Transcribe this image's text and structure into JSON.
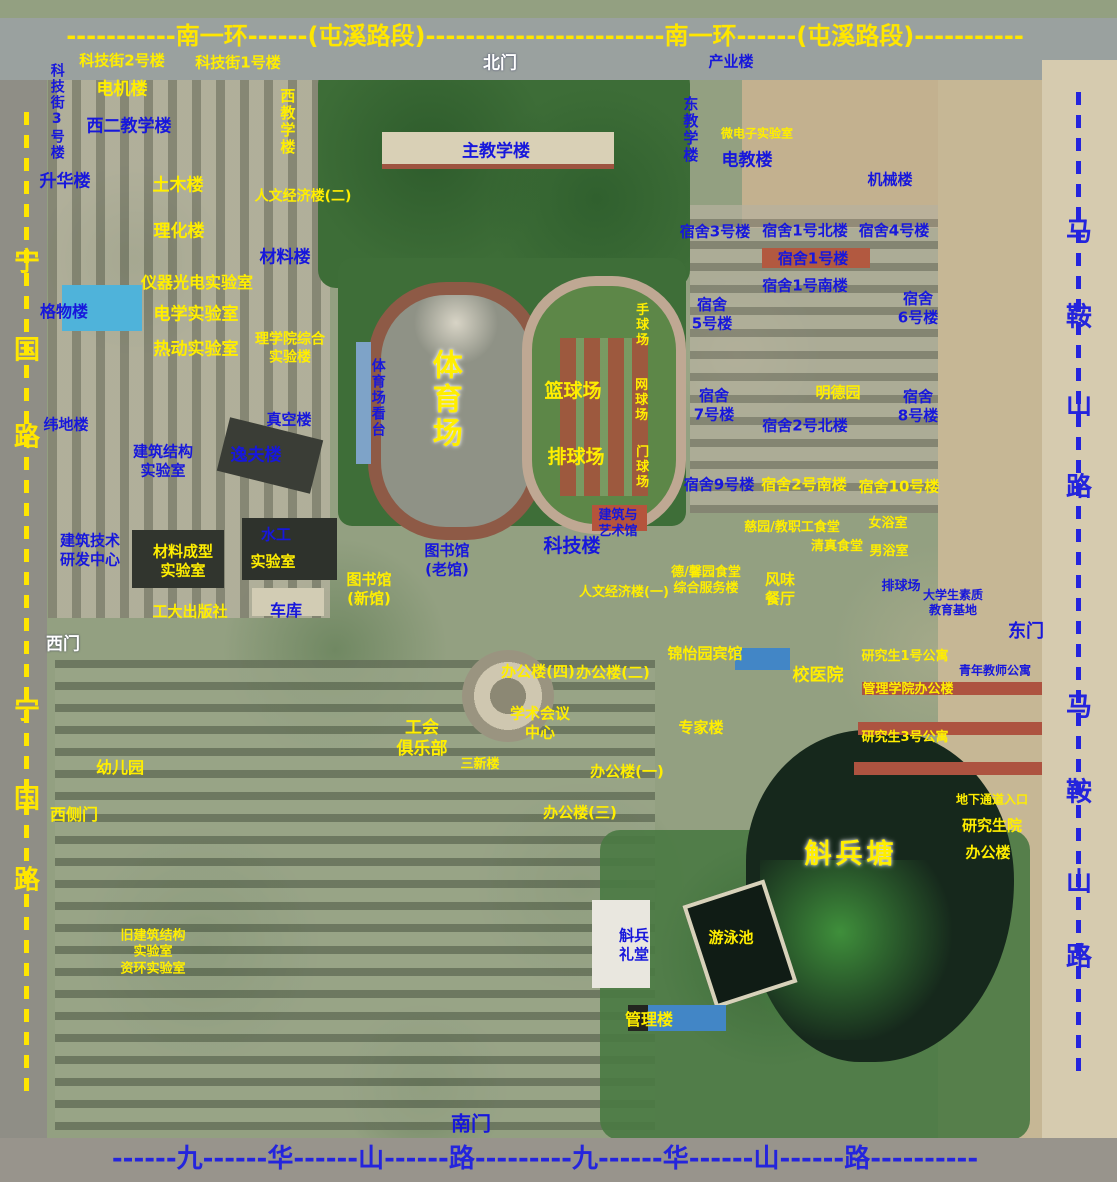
{
  "meta": {
    "type": "campus-satellite-map"
  },
  "colors": {
    "label_yellow": "#ffee00",
    "label_blue": "#1717dc",
    "label_white": "#ffffff",
    "road_top_text": "#ffe600",
    "road_bottom_text": "#2424dd"
  },
  "roads": {
    "top": {
      "name": "南一环(屯溪路段)",
      "display": "-----------南一环------(屯溪路段)------------------------南一环------(屯溪路段)-----------"
    },
    "bottom": {
      "name": "九华山路",
      "display": "------九------华------山------路---------九------华------山------路----------"
    },
    "left": {
      "name": "宁国路",
      "chars": [
        {
          "t": "宁",
          "y": 260
        },
        {
          "t": "国",
          "y": 348
        },
        {
          "t": "路",
          "y": 435
        },
        {
          "t": "宁",
          "y": 708
        },
        {
          "t": "国",
          "y": 797
        },
        {
          "t": "路",
          "y": 878
        }
      ]
    },
    "right": {
      "name": "马鞍山路",
      "chars": [
        {
          "t": "马",
          "y": 230
        },
        {
          "t": "鞍",
          "y": 315
        },
        {
          "t": "山",
          "y": 403
        },
        {
          "t": "路",
          "y": 485
        },
        {
          "t": "马",
          "y": 705
        },
        {
          "t": "鞍",
          "y": 790
        },
        {
          "t": "山",
          "y": 880
        },
        {
          "t": "路",
          "y": 955
        }
      ]
    }
  },
  "labels": [
    {
      "t": "科技街2号楼",
      "x": 122,
      "y": 61,
      "c": "y"
    },
    {
      "t": "科技街1号楼",
      "x": 238,
      "y": 63,
      "c": "y"
    },
    {
      "t": "北门",
      "x": 500,
      "y": 64,
      "c": "w",
      "s": 17
    },
    {
      "t": "产业楼",
      "x": 731,
      "y": 62,
      "c": "b"
    },
    {
      "t": "科技街3号楼",
      "x": 56,
      "y": 112,
      "c": "b",
      "v": 1,
      "s": 14
    },
    {
      "t": "电机楼",
      "x": 122,
      "y": 90,
      "c": "y",
      "s": 17
    },
    {
      "t": "西教学楼",
      "x": 287,
      "y": 122,
      "c": "y",
      "v": 1
    },
    {
      "t": "东教学楼",
      "x": 690,
      "y": 130,
      "c": "b",
      "v": 1
    },
    {
      "t": "微电子实验室",
      "x": 757,
      "y": 134,
      "c": "y",
      "s": 12
    },
    {
      "t": "西二教学楼",
      "x": 129,
      "y": 127,
      "c": "b",
      "s": 17
    },
    {
      "t": "主教学楼",
      "x": 496,
      "y": 152,
      "c": "b",
      "s": 17
    },
    {
      "t": "电教楼",
      "x": 747,
      "y": 161,
      "c": "b",
      "s": 17
    },
    {
      "t": "机械楼",
      "x": 890,
      "y": 180,
      "c": "b"
    },
    {
      "t": "升华楼",
      "x": 65,
      "y": 182,
      "c": "b",
      "s": 17
    },
    {
      "t": "土木楼",
      "x": 178,
      "y": 186,
      "c": "y",
      "s": 17
    },
    {
      "t": "人文经济楼(二)",
      "x": 303,
      "y": 197,
      "c": "y",
      "s": 14
    },
    {
      "t": "理化楼",
      "x": 179,
      "y": 232,
      "c": "y",
      "s": 17
    },
    {
      "t": "材料楼",
      "x": 285,
      "y": 258,
      "c": "b",
      "s": 17
    },
    {
      "t": "宿舍3号楼",
      "x": 715,
      "y": 232,
      "c": "b"
    },
    {
      "t": "宿舍1号北楼",
      "x": 805,
      "y": 231,
      "c": "b"
    },
    {
      "t": "宿舍4号楼",
      "x": 894,
      "y": 231,
      "c": "b"
    },
    {
      "t": "宿舍1号楼",
      "x": 813,
      "y": 259,
      "c": "b"
    },
    {
      "t": "宿舍1号南楼",
      "x": 805,
      "y": 286,
      "c": "b"
    },
    {
      "t": "仪器光电实验室",
      "x": 197,
      "y": 283,
      "c": "y",
      "s": 16
    },
    {
      "t": "格物楼",
      "x": 64,
      "y": 312,
      "c": "b",
      "s": 16
    },
    {
      "t": "电学实验室",
      "x": 196,
      "y": 315,
      "c": "y",
      "s": 17
    },
    {
      "t": "热动实验室",
      "x": 196,
      "y": 350,
      "c": "y",
      "s": 17
    },
    {
      "t": "理学院综合\n实验楼",
      "x": 290,
      "y": 349,
      "c": "y",
      "s": 14
    },
    {
      "t": "宿舍\n5号楼",
      "x": 712,
      "y": 314,
      "c": "b"
    },
    {
      "t": "宿舍\n6号楼",
      "x": 918,
      "y": 308,
      "c": "b"
    },
    {
      "t": "体育场看台",
      "x": 377,
      "y": 398,
      "c": "b",
      "v": 1,
      "s": 14
    },
    {
      "t": "体育场",
      "x": 444,
      "y": 400,
      "c": "y",
      "v": 1,
      "s": 30,
      "big": 1
    },
    {
      "t": "手球场",
      "x": 640,
      "y": 325,
      "c": "y",
      "v": 1,
      "s": 13
    },
    {
      "t": "篮球场",
      "x": 573,
      "y": 392,
      "c": "y",
      "s": 19
    },
    {
      "t": "网球场",
      "x": 639,
      "y": 400,
      "c": "y",
      "v": 1,
      "s": 13
    },
    {
      "t": "排球场",
      "x": 576,
      "y": 458,
      "c": "y",
      "s": 19
    },
    {
      "t": "门球场",
      "x": 640,
      "y": 467,
      "c": "y",
      "v": 1,
      "s": 13
    },
    {
      "t": "明德园",
      "x": 838,
      "y": 393,
      "c": "y"
    },
    {
      "t": "宿舍\n7号楼",
      "x": 714,
      "y": 405,
      "c": "b"
    },
    {
      "t": "宿舍\n8号楼",
      "x": 918,
      "y": 406,
      "c": "b"
    },
    {
      "t": "宿舍2号北楼",
      "x": 805,
      "y": 426,
      "c": "b"
    },
    {
      "t": "真空楼",
      "x": 289,
      "y": 420,
      "c": "b"
    },
    {
      "t": "纬地楼",
      "x": 66,
      "y": 425,
      "c": "b"
    },
    {
      "t": "建筑结构\n实验室",
      "x": 163,
      "y": 461,
      "c": "b"
    },
    {
      "t": "逸夫楼",
      "x": 256,
      "y": 456,
      "c": "b",
      "s": 17
    },
    {
      "t": "宿舍9号楼",
      "x": 719,
      "y": 485,
      "c": "b"
    },
    {
      "t": "宿舍2号南楼",
      "x": 804,
      "y": 485,
      "c": "y"
    },
    {
      "t": "宿舍10号楼",
      "x": 899,
      "y": 487,
      "c": "y"
    },
    {
      "t": "建筑与\n艺术馆",
      "x": 618,
      "y": 524,
      "c": "b",
      "s": 13
    },
    {
      "t": "建筑技术\n研发中心",
      "x": 90,
      "y": 550,
      "c": "b"
    },
    {
      "t": "材料成型\n实验室",
      "x": 183,
      "y": 561,
      "c": "y"
    },
    {
      "t": "水工",
      "x": 276,
      "y": 535,
      "c": "b"
    },
    {
      "t": "实验室",
      "x": 273,
      "y": 562,
      "c": "y"
    },
    {
      "t": "图书馆\n(老馆)",
      "x": 447,
      "y": 560,
      "c": "b"
    },
    {
      "t": "科技楼",
      "x": 572,
      "y": 547,
      "c": "b",
      "s": 19
    },
    {
      "t": "慈园/教职工食堂",
      "x": 792,
      "y": 528,
      "c": "y",
      "s": 13
    },
    {
      "t": "女浴室",
      "x": 888,
      "y": 524,
      "c": "y",
      "s": 13
    },
    {
      "t": "清真食堂",
      "x": 837,
      "y": 547,
      "c": "y",
      "s": 13
    },
    {
      "t": "男浴室",
      "x": 889,
      "y": 552,
      "c": "y",
      "s": 13
    },
    {
      "t": "图书馆\n(新馆)",
      "x": 369,
      "y": 589,
      "c": "y"
    },
    {
      "t": "人文经济楼(一)",
      "x": 624,
      "y": 593,
      "c": "y",
      "s": 13
    },
    {
      "t": "德/馨园食堂\n综合服务楼",
      "x": 706,
      "y": 581,
      "c": "y",
      "s": 13
    },
    {
      "t": "风味\n餐厅",
      "x": 780,
      "y": 589,
      "c": "y"
    },
    {
      "t": "排球场",
      "x": 901,
      "y": 587,
      "c": "b",
      "s": 13
    },
    {
      "t": "大学生素质\n教育基地",
      "x": 953,
      "y": 603,
      "c": "b",
      "s": 12
    },
    {
      "t": "工大出版社",
      "x": 190,
      "y": 612,
      "c": "y"
    },
    {
      "t": "车库",
      "x": 286,
      "y": 611,
      "c": "b",
      "s": 16
    },
    {
      "t": "东门",
      "x": 1026,
      "y": 632,
      "c": "b",
      "s": 18
    },
    {
      "t": "西门",
      "x": 63,
      "y": 645,
      "c": "w",
      "s": 17
    },
    {
      "t": "锦怡园宾馆",
      "x": 705,
      "y": 654,
      "c": "y"
    },
    {
      "t": "研究生1号公寓",
      "x": 905,
      "y": 657,
      "c": "y",
      "s": 13
    },
    {
      "t": "办公楼(四)",
      "x": 538,
      "y": 672,
      "c": "y"
    },
    {
      "t": "办公楼(二)",
      "x": 613,
      "y": 673,
      "c": "y"
    },
    {
      "t": "校医院",
      "x": 818,
      "y": 676,
      "c": "y",
      "s": 17
    },
    {
      "t": "青年教师公寓",
      "x": 995,
      "y": 671,
      "c": "b",
      "s": 12
    },
    {
      "t": "管理学院办公楼",
      "x": 908,
      "y": 690,
      "c": "y",
      "s": 13
    },
    {
      "t": "学术会议\n中心",
      "x": 540,
      "y": 723,
      "c": "y"
    },
    {
      "t": "工会\n俱乐部",
      "x": 422,
      "y": 739,
      "c": "y",
      "s": 17
    },
    {
      "t": "专家楼",
      "x": 701,
      "y": 728,
      "c": "y"
    },
    {
      "t": "研究生3号公寓",
      "x": 905,
      "y": 738,
      "c": "y",
      "s": 13
    },
    {
      "t": "三新楼",
      "x": 480,
      "y": 765,
      "c": "y",
      "s": 13
    },
    {
      "t": "办公楼(一)",
      "x": 627,
      "y": 772,
      "c": "y"
    },
    {
      "t": "幼儿园",
      "x": 120,
      "y": 768,
      "c": "y",
      "s": 16
    },
    {
      "t": "办公楼(三)",
      "x": 580,
      "y": 813,
      "c": "y"
    },
    {
      "t": "西侧门",
      "x": 74,
      "y": 815,
      "c": "y",
      "s": 16
    },
    {
      "t": "地下通道入口",
      "x": 992,
      "y": 800,
      "c": "y",
      "s": 12
    },
    {
      "t": "研究生院",
      "x": 992,
      "y": 826,
      "c": "y"
    },
    {
      "t": "办公楼",
      "x": 988,
      "y": 853,
      "c": "y"
    },
    {
      "t": "斛兵塘",
      "x": 851,
      "y": 855,
      "c": "y",
      "s": 27,
      "big": 1
    },
    {
      "t": "旧建筑结构\n实验室\n资环实验室",
      "x": 153,
      "y": 953,
      "c": "y",
      "s": 13
    },
    {
      "t": "斛兵\n礼堂",
      "x": 634,
      "y": 945,
      "c": "b"
    },
    {
      "t": "游泳池",
      "x": 731,
      "y": 938,
      "c": "y"
    },
    {
      "t": "管理楼",
      "x": 649,
      "y": 1020,
      "c": "y",
      "s": 16
    },
    {
      "t": "南门",
      "x": 471,
      "y": 1124,
      "c": "b",
      "s": 20
    }
  ]
}
